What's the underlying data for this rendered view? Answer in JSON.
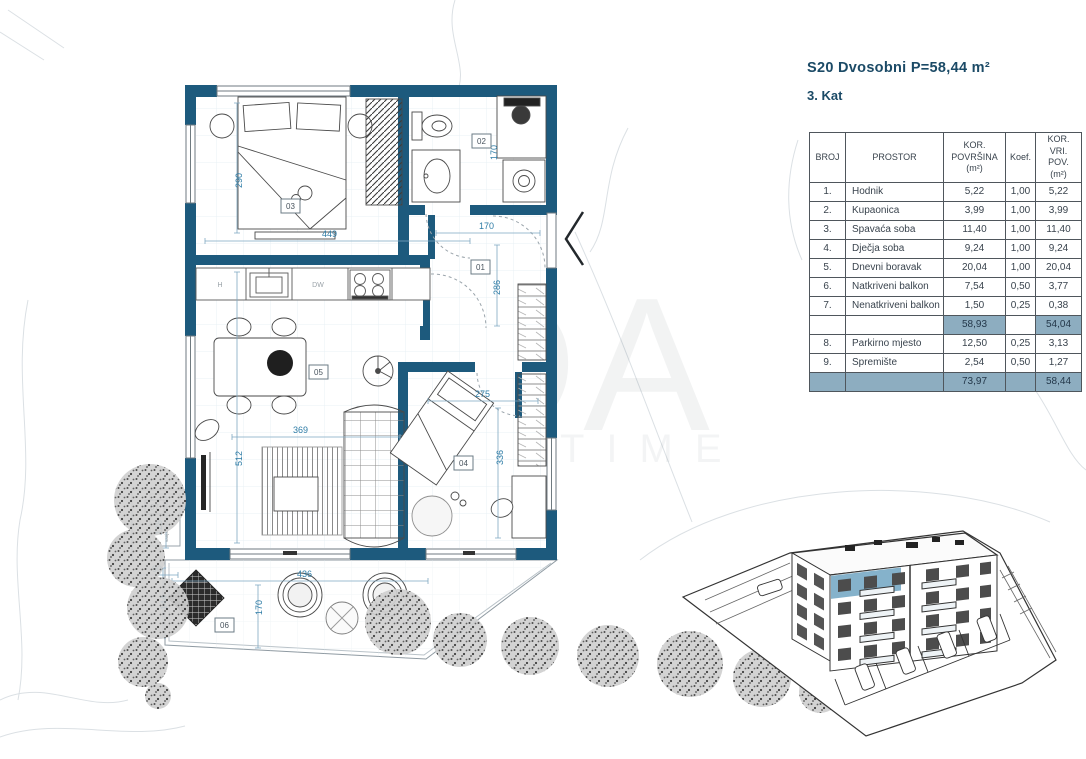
{
  "header": {
    "title": "S20 Dvosobni  P=58,44 m²",
    "floor_label": "3. Kat"
  },
  "table": {
    "col_headers": [
      "BROJ",
      "PROSTOR",
      "KOR.\nPOVRŠINA\n(m²)",
      "Koef.",
      "KOR. VRI.\nPOV.\n(m²)"
    ],
    "rows": [
      {
        "broj": "1.",
        "prostor": "Hodnik",
        "povrsina": "5,22",
        "koef": "1,00",
        "vrijednost": "5,22"
      },
      {
        "broj": "2.",
        "prostor": "Kupaonica",
        "povrsina": "3,99",
        "koef": "1,00",
        "vrijednost": "3,99"
      },
      {
        "broj": "3.",
        "prostor": "Spavaća soba",
        "povrsina": "11,40",
        "koef": "1,00",
        "vrijednost": "11,40"
      },
      {
        "broj": "4.",
        "prostor": "Dječja soba",
        "povrsina": "9,24",
        "koef": "1,00",
        "vrijednost": "9,24"
      },
      {
        "broj": "5.",
        "prostor": "Dnevni boravak",
        "povrsina": "20,04",
        "koef": "1,00",
        "vrijednost": "20,04"
      },
      {
        "broj": "6.",
        "prostor": "Natkriveni balkon",
        "povrsina": "7,54",
        "koef": "0,50",
        "vrijednost": "3,77"
      },
      {
        "broj": "7.",
        "prostor": "Nenatkriveni balkon",
        "povrsina": "1,50",
        "koef": "0,25",
        "vrijednost": "0,38"
      },
      {
        "broj": "",
        "prostor": "",
        "povrsina": "58,93",
        "koef": "",
        "vrijednost": "54,04"
      },
      {
        "broj": "8.",
        "prostor": "Parkirno mjesto",
        "povrsina": "12,50",
        "koef": "0,25",
        "vrijednost": "3,13"
      },
      {
        "broj": "9.",
        "prostor": "Spremište",
        "povrsina": "2,54",
        "koef": "0,50",
        "vrijednost": "1,27"
      },
      {
        "broj": "",
        "prostor": "",
        "povrsina": "73,97",
        "koef": "",
        "vrijednost": "58,44"
      }
    ]
  },
  "floorplan": {
    "room_labels": {
      "hallway": "01",
      "bathroom": "02",
      "bedroom": "03",
      "kids_room": "04",
      "living_room": "05",
      "balcony": "06",
      "ac_unit": "07"
    },
    "kitchen": {
      "fridge": "H",
      "dishwasher": "DW"
    },
    "ac_note": "vanjska klima jedinica",
    "dimensions": {
      "bedroom_width": "449",
      "bedroom_height": "290",
      "hall_width": "170",
      "bath_height": "170",
      "hall_height": "286",
      "living_width": "369",
      "living_height": "512",
      "kids_width": "275",
      "kids_height": "336",
      "balcony_width": "436",
      "balcony_depth": "170",
      "terrace_depth": "144",
      "terrace_width": "90",
      "planter_height": "128"
    }
  },
  "watermark": {
    "large": "DA",
    "small": "TIME"
  },
  "colors": {
    "wall": "#1d5a7d",
    "dimension": "#2e7ca6",
    "table_shade": "#8dadc0",
    "title": "#1b4a66",
    "highlight_unit": "#85b2cb"
  }
}
